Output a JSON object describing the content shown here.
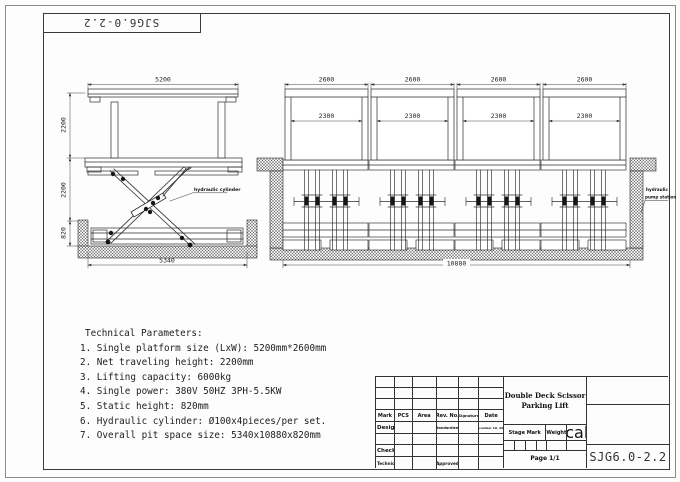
{
  "sheet": {
    "top_code": "SJG6.0-2.2"
  },
  "side_view": {
    "dim_platform_length": "5200",
    "dim_travel_upper": "2200",
    "dim_travel_lower": "2200",
    "dim_pit_depth": "820",
    "dim_pit_length": "5340",
    "cylinder_label": "hydraulic cylinder"
  },
  "front_view": {
    "dim_platform_width": "2600",
    "dim_inner_width": "2300",
    "dim_total_length": "10880",
    "pump_label_line1": "hydraulic",
    "pump_label_line2": "pump station"
  },
  "tech_params": {
    "heading": "Technical Parameters:",
    "items": [
      "1. Single platform size (LxW): 5200mm*2600mm",
      "2. Net traveling height: 2200mm",
      "3. Lifting capacity: 6000kg",
      "4. Single power: 380V 50HZ 3PH-5.5KW",
      "5. Static height: 820mm",
      "6. Hydraulic cylinder: Ø100x4pieces/per set.",
      "7. Overall pit space size: 5340x10880x820mm"
    ]
  },
  "title_block": {
    "product_title_line1": "Double Deck Scissor",
    "product_title_line2": "Parking Lift",
    "col_mark": "Mark",
    "col_pcs": "PCS",
    "col_area": "Area",
    "col_rev_no": "Rev. No.",
    "col_signature": "Signature",
    "col_date": "Date",
    "row_design": "Design",
    "row_check": "Check",
    "row_technical": "Technical",
    "cell_standardized": "Standardized",
    "cell_approved": "Approved",
    "cell_date_value": "December 10, 2008",
    "stage_mark": "Stage Mark",
    "weight": "Weight",
    "scale": "Scale",
    "page": "Page 1/1",
    "drawing_code": "SJG6.0-2.2"
  }
}
